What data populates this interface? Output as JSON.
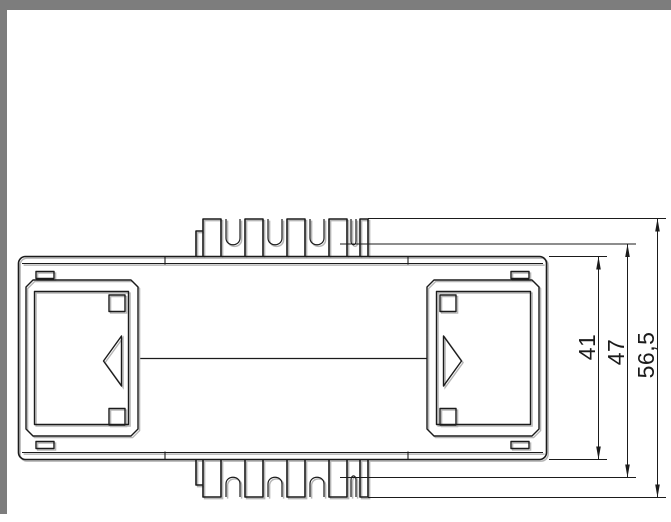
{
  "window": {
    "background": "#ffffff",
    "frame_color": "#7d7d7d"
  },
  "drawing": {
    "line_color": "#1b1b1b",
    "shadow_color": "#b6b6b6",
    "dimensions": [
      {
        "label": "41"
      },
      {
        "label": "47"
      },
      {
        "label": "56,5"
      }
    ]
  }
}
